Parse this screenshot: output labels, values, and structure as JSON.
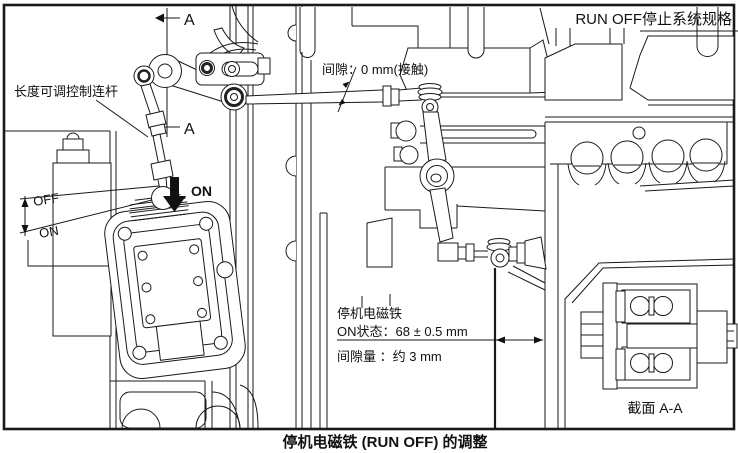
{
  "figure": {
    "caption": "停机电磁铁 (RUN OFF) 的调整",
    "spec_label": "RUN OFF停止系统规格",
    "link_label": "长度可调控制连杆",
    "gap_label": "间隙：0 mm(接触)",
    "off_label": "OFF",
    "on_label": "ON",
    "plunger_on_label": "ON",
    "section_letter_top": "A",
    "section_letter_bottom": "A",
    "solenoid_spec": {
      "title": "停机电磁铁",
      "on_state": "ON状态：68 ± 0.5 mm",
      "gap_amount": "间隙量 ：约 3 mm"
    },
    "section_view_label": "截面 A-A"
  }
}
